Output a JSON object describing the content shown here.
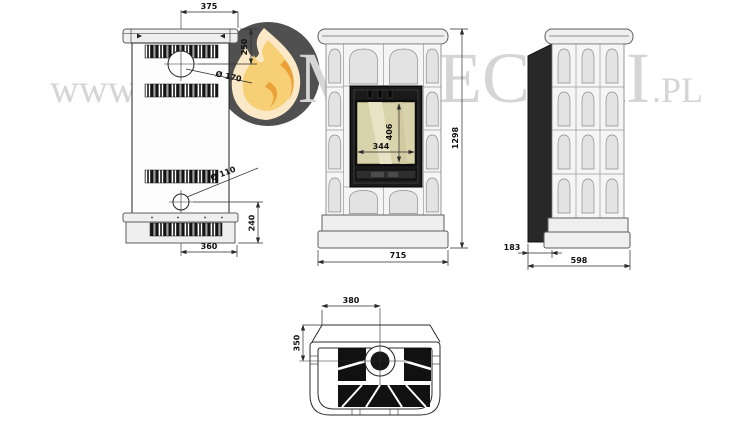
{
  "watermark": {
    "prefix": "www.",
    "brand_first_letter": "K",
    "brand_rest": "MINECZKI",
    "tld": ".PL",
    "logo_icon": "flame-in-circle-logo",
    "text_color": "#d3d3d3",
    "logo_circle_color": "#474747",
    "flame_cream": "#fbe7c3",
    "flame_yellow": "#f7cd6d",
    "flame_orange": "#ea9c2d"
  },
  "drawing": {
    "line_color": "#2b2b2b",
    "views": {
      "rear": {
        "label": "rear-panel-view",
        "dim_top_width": "375",
        "dim_flue_offset": "250",
        "flue_diameter": "Ø 170",
        "lower_port_diameter": "Ø 110",
        "dim_lower_offset": "240",
        "dim_bottom_width": "360"
      },
      "front": {
        "label": "front-view",
        "dim_glass_width": "344",
        "dim_glass_height": "406",
        "dim_total_height": "1298",
        "dim_total_width": "715"
      },
      "side": {
        "label": "side-view",
        "dim_rear_channel": "183",
        "dim_total_depth": "598"
      },
      "top": {
        "label": "top-section-view",
        "dim_flue_from_edge": "380",
        "dim_flue_from_front": "350"
      }
    }
  }
}
